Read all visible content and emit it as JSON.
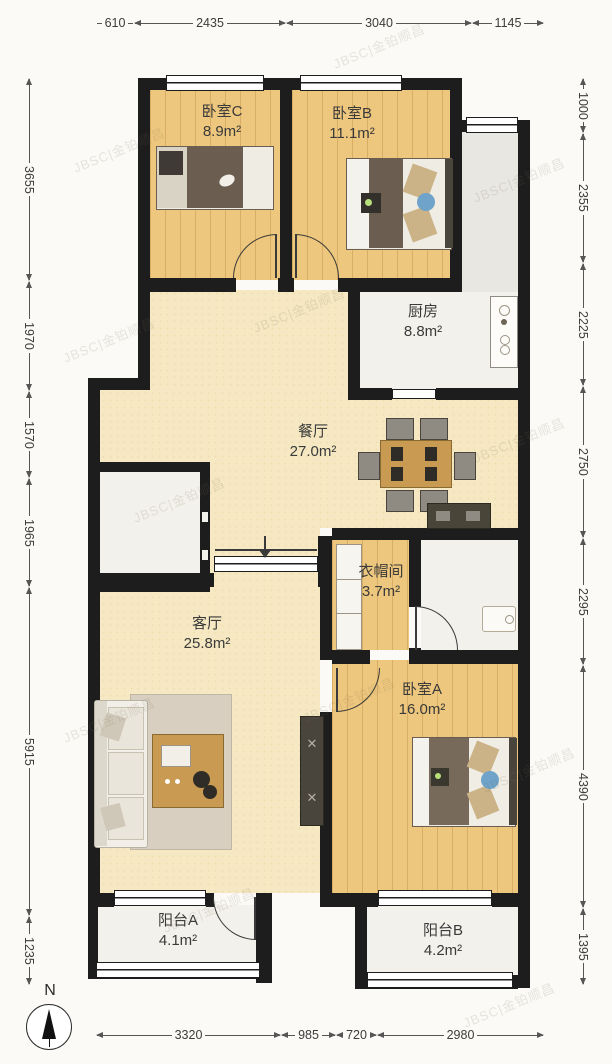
{
  "plan": {
    "rooms": {
      "bedroomC": {
        "label": "卧室C",
        "area": "8.9m²"
      },
      "bedroomB": {
        "label": "卧室B",
        "area": "11.1m²"
      },
      "kitchen": {
        "label": "厨房",
        "area": "8.8m²"
      },
      "dining": {
        "label": "餐厅",
        "area": "27.0m²"
      },
      "closet": {
        "label": "衣帽间",
        "area": "3.7m²"
      },
      "living": {
        "label": "客厅",
        "area": "25.8m²"
      },
      "bedroomA": {
        "label": "卧室A",
        "area": "16.0m²"
      },
      "balconyA": {
        "label": "阳台A",
        "area": "4.1m²"
      },
      "balconyB": {
        "label": "阳台B",
        "area": "4.2m²"
      }
    },
    "compass_label": "N",
    "watermark": "JBSC|金铂顺昌",
    "colors": {
      "wall": "#1d1d1d",
      "wood_floor": "#edc77d",
      "cream_floor": "#f5e8c2",
      "white_floor": "#f3f1eb",
      "corridor_floor": "#e9e7e2",
      "dimension_text": "#3c3c3c"
    }
  },
  "dims": {
    "top": [
      "610",
      "2435",
      "3040",
      "1145"
    ],
    "bottom": [
      "3320",
      "985",
      "720",
      "2980"
    ],
    "left": [
      "3655",
      "1970",
      "1570",
      "1965",
      "5915",
      "1235"
    ],
    "right": [
      "1000",
      "2355",
      "2225",
      "2750",
      "2295",
      "4390",
      "1395"
    ]
  }
}
